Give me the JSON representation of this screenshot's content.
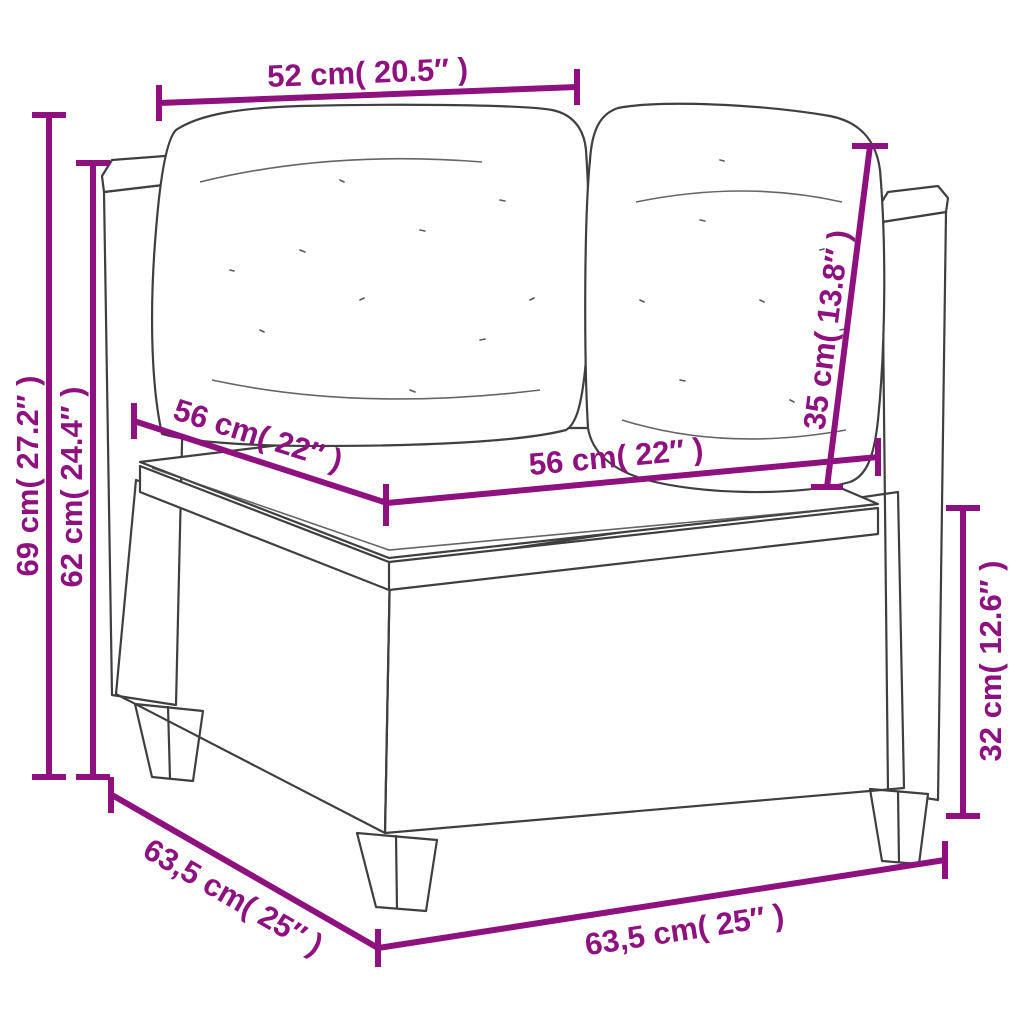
{
  "diagram": {
    "colors": {
      "accent": "#8e117f",
      "line_art": "#3f3f3f",
      "background": "#ffffff"
    },
    "dimensions": {
      "top_width": "52 cm( 20.5″ )",
      "total_height": "69 cm( 27.2″ )",
      "armrest_height": "62 cm( 24.4″ )",
      "seat_depth": "56 cm( 22″ )",
      "seat_width": "56 cm( 22″ )",
      "backrest_height": "35 cm( 13.8″ )",
      "base_height": "32 cm( 12.6″ )",
      "overall_depth": "63,5 cm( 25″ )",
      "overall_width": "63,5 cm( 25″ )"
    }
  }
}
